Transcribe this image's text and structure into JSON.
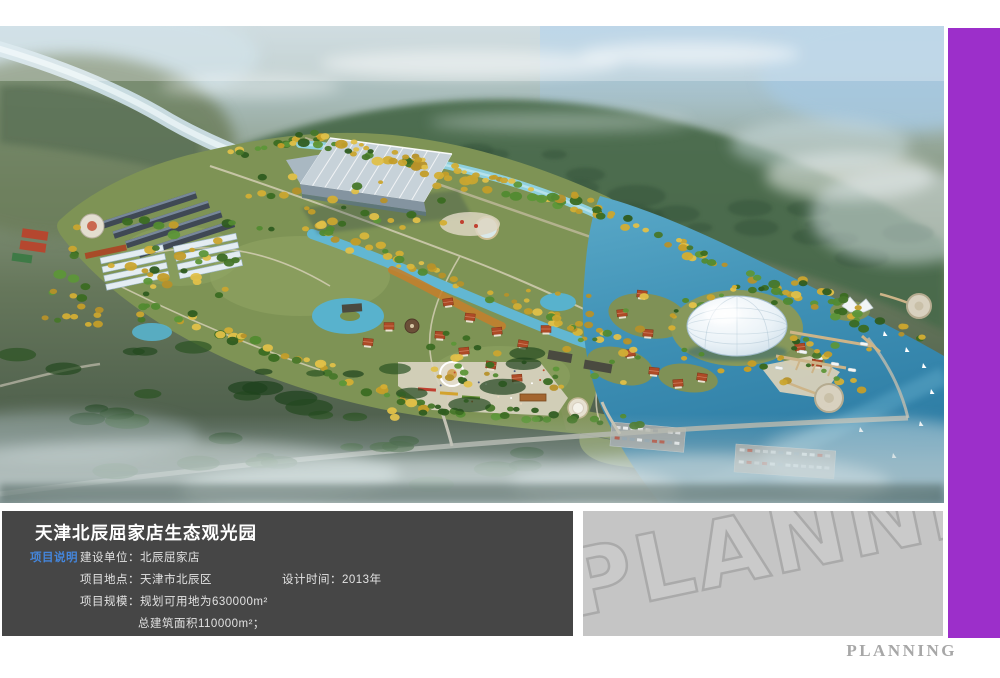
{
  "board": {
    "title": "天津北辰屈家店生态观光园",
    "section_label": "项目说明",
    "fields": {
      "unit_label": "建设单位：",
      "unit_value": "北辰屈家店",
      "location_label": "项目地点：",
      "location_value": "天津市北辰区",
      "time_label": "设计时间：",
      "time_value": "2013年",
      "scale_label": "项目规模：",
      "scale_value": "规划可用地为630000m²",
      "area_value": "总建筑面积110000m²；"
    },
    "watermark": "PLANNING",
    "footer_logo": "PLANNING",
    "colors": {
      "accent_purple": "#9c2fca",
      "info_panel_bg": "#464646",
      "watermark_panel_bg": "#c5c5c5",
      "section_label_blue": "#4486dc",
      "footer_gray": "#a7a7a7"
    }
  }
}
